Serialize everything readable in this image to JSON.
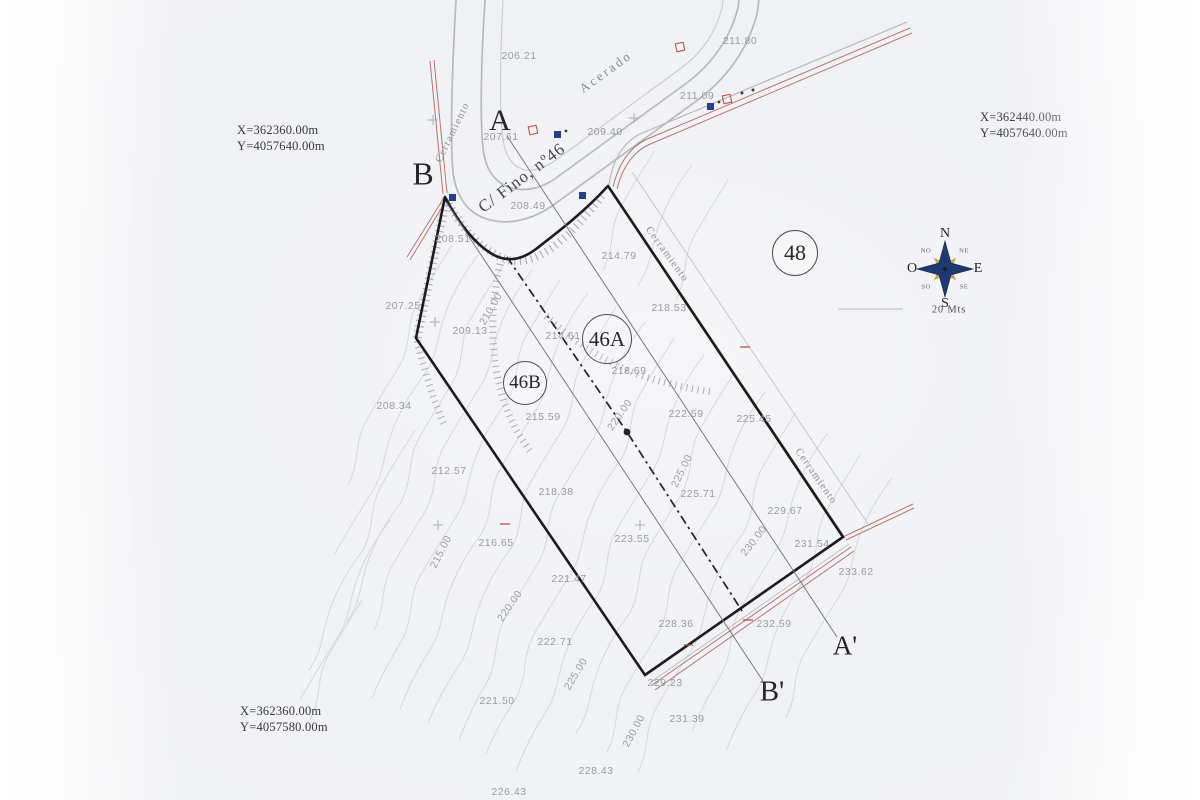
{
  "corner_coordinates": {
    "top_left": {
      "x_label": "X=362360.00m",
      "y_label": "Y=4057640.00m"
    },
    "top_right": {
      "x_label": "X=362440.00m",
      "y_label": "Y=4057640.00m"
    },
    "bottom_left": {
      "x_label": "X=362360.00m",
      "y_label": "Y=4057580.00m"
    }
  },
  "compass": {
    "north": "N",
    "south": "S",
    "east": "E",
    "west": "O",
    "northwest": "NO",
    "northeast": "NE",
    "southwest": "SO",
    "southeast": "SE",
    "scale_label": "20 Mts"
  },
  "parcels": [
    {
      "id": "48"
    },
    {
      "id": "46A"
    },
    {
      "id": "46B"
    }
  ],
  "streets": {
    "sidewalk_label": "Acerado",
    "street_name": "C/ Fino, nº46",
    "fence_label": "Cerramiento"
  },
  "sections": {
    "a": "A",
    "a_prime": "A'",
    "b": "B",
    "b_prime": "B'"
  },
  "spot_elevations": [
    {
      "v": "206.21",
      "x": 519,
      "y": 56
    },
    {
      "v": "211.80",
      "x": 740,
      "y": 41
    },
    {
      "v": "211.09",
      "x": 697,
      "y": 96
    },
    {
      "v": "209.40",
      "x": 605,
      "y": 132
    },
    {
      "v": "207.61",
      "x": 501,
      "y": 137
    },
    {
      "v": "208.49",
      "x": 528,
      "y": 206
    },
    {
      "v": "208.51",
      "x": 453,
      "y": 239
    },
    {
      "v": "214.79",
      "x": 619,
      "y": 256
    },
    {
      "v": "218.53",
      "x": 669,
      "y": 308
    },
    {
      "v": "207.25",
      "x": 403,
      "y": 306
    },
    {
      "v": "209.13",
      "x": 470,
      "y": 331
    },
    {
      "v": "214.61",
      "x": 563,
      "y": 336
    },
    {
      "v": "218.69",
      "x": 629,
      "y": 371
    },
    {
      "v": "208.34",
      "x": 394,
      "y": 406
    },
    {
      "v": "215.59",
      "x": 543,
      "y": 417
    },
    {
      "v": "222.59",
      "x": 686,
      "y": 414
    },
    {
      "v": "225.45",
      "x": 754,
      "y": 419
    },
    {
      "v": "212.57",
      "x": 449,
      "y": 471
    },
    {
      "v": "218.38",
      "x": 556,
      "y": 492
    },
    {
      "v": "225.71",
      "x": 698,
      "y": 494
    },
    {
      "v": "229.67",
      "x": 785,
      "y": 511
    },
    {
      "v": "223.55",
      "x": 632,
      "y": 539
    },
    {
      "v": "216.65",
      "x": 496,
      "y": 543
    },
    {
      "v": "231.54",
      "x": 812,
      "y": 544
    },
    {
      "v": "233.62",
      "x": 856,
      "y": 572
    },
    {
      "v": "221.47",
      "x": 569,
      "y": 579
    },
    {
      "v": "228.36",
      "x": 676,
      "y": 624
    },
    {
      "v": "232.59",
      "x": 774,
      "y": 624
    },
    {
      "v": "222.71",
      "x": 555,
      "y": 642
    },
    {
      "v": "229.23",
      "x": 665,
      "y": 683
    },
    {
      "v": "221.50",
      "x": 497,
      "y": 701
    },
    {
      "v": "231.39",
      "x": 687,
      "y": 719
    },
    {
      "v": "228.43",
      "x": 596,
      "y": 771
    },
    {
      "v": "226.43",
      "x": 509,
      "y": 792
    }
  ],
  "contour_labels": [
    {
      "v": "210.00",
      "x": 491,
      "y": 309,
      "r": -60
    },
    {
      "v": "220.00",
      "x": 620,
      "y": 415,
      "r": -55
    },
    {
      "v": "225.00",
      "x": 682,
      "y": 471,
      "r": -64
    },
    {
      "v": "230.00",
      "x": 754,
      "y": 541,
      "r": -52
    },
    {
      "v": "215.00",
      "x": 441,
      "y": 552,
      "r": -63
    },
    {
      "v": "220.00",
      "x": 510,
      "y": 606,
      "r": -55
    },
    {
      "v": "225.00",
      "x": 576,
      "y": 674,
      "r": -59
    },
    {
      "v": "230.00",
      "x": 634,
      "y": 731,
      "r": -62
    }
  ],
  "colors": {
    "boundary": "#1c1c1f",
    "fence": "#b5756b",
    "road": "#b6b9be",
    "sidewalk": "#c8cbd0",
    "contour": "#ccd1d8",
    "section-line": "#77797e",
    "lamp": "#23408e",
    "red-symbol": "#c0504a",
    "compass-navy": "#1e3a72",
    "compass-gold": "#c9a43e"
  }
}
